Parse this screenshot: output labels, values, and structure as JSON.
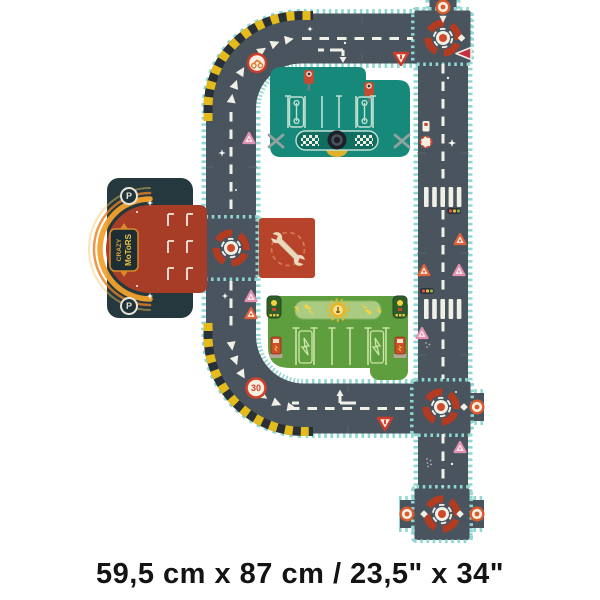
{
  "caption": {
    "dimensions": "59,5 cm x 87 cm / 23,5\" x 34\""
  },
  "garage": {
    "brand_line1": "CRAZY",
    "brand_line2": "MoToRS",
    "parking_letter": "P"
  },
  "signs": {
    "speed_limit_30": "30"
  },
  "colors": {
    "background": "#ffffff",
    "road": "#4a545e",
    "road_trim_teal": "#8fd8d2",
    "hazard_yellow": "#e3bb1c",
    "hazard_dark": "#2a3037",
    "road_marking": "#f0f0e6",
    "roundabout_red": "#b23b22",
    "sign_orange": "#d95b2d",
    "sign_pink": "#e390b5",
    "pit_mat_teal": "#17897a",
    "charging_mat_green": "#5f9e3f",
    "garage_body": "#24383e",
    "garage_pad_red": "#a73d27",
    "garage_arch_orange": "#f2a12c",
    "wrench_piece_red": "#b7442a",
    "wrench_cream": "#ead9bc",
    "caption_text": "#141414"
  },
  "icons": {
    "roundabout-icon": "broken red ring with white center and red dot",
    "warning-triangle-icon": "orange-bordered triangle",
    "pink-triangle-icon": "pink-bordered triangle",
    "yield-sign-icon": "red inverted triangle",
    "ring-sign-icon": "orange ring circular sign",
    "traffic-light-icon": "three-dot traffic light",
    "wrench-icon": "double open-end wrench",
    "sparkle-icon": "four point star"
  },
  "pieces": [
    "garage",
    "parking-roundabout",
    "top-left-curve",
    "top-road",
    "top-roundabout",
    "right-road",
    "pit-stop-mat",
    "repair-mat",
    "charging-mat",
    "mid-roundabout",
    "bottom-road",
    "bottom-left-curve",
    "bottom-roundabout"
  ]
}
